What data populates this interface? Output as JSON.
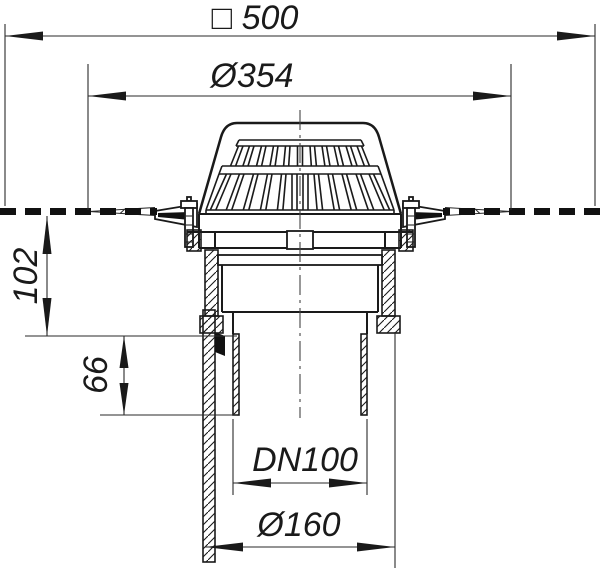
{
  "drawing": {
    "type": "technical-dimension-drawing",
    "subject": "roof-drain-cross-section",
    "colors": {
      "line": "#1a1a1a",
      "background": "#ffffff"
    },
    "dimensions": {
      "overall_width": "□ 500",
      "flange_diameter": "Ø354",
      "install_height": "102",
      "spigot_length": "66",
      "nominal_diameter": "DN100",
      "outlet_diameter": "Ø160"
    }
  }
}
